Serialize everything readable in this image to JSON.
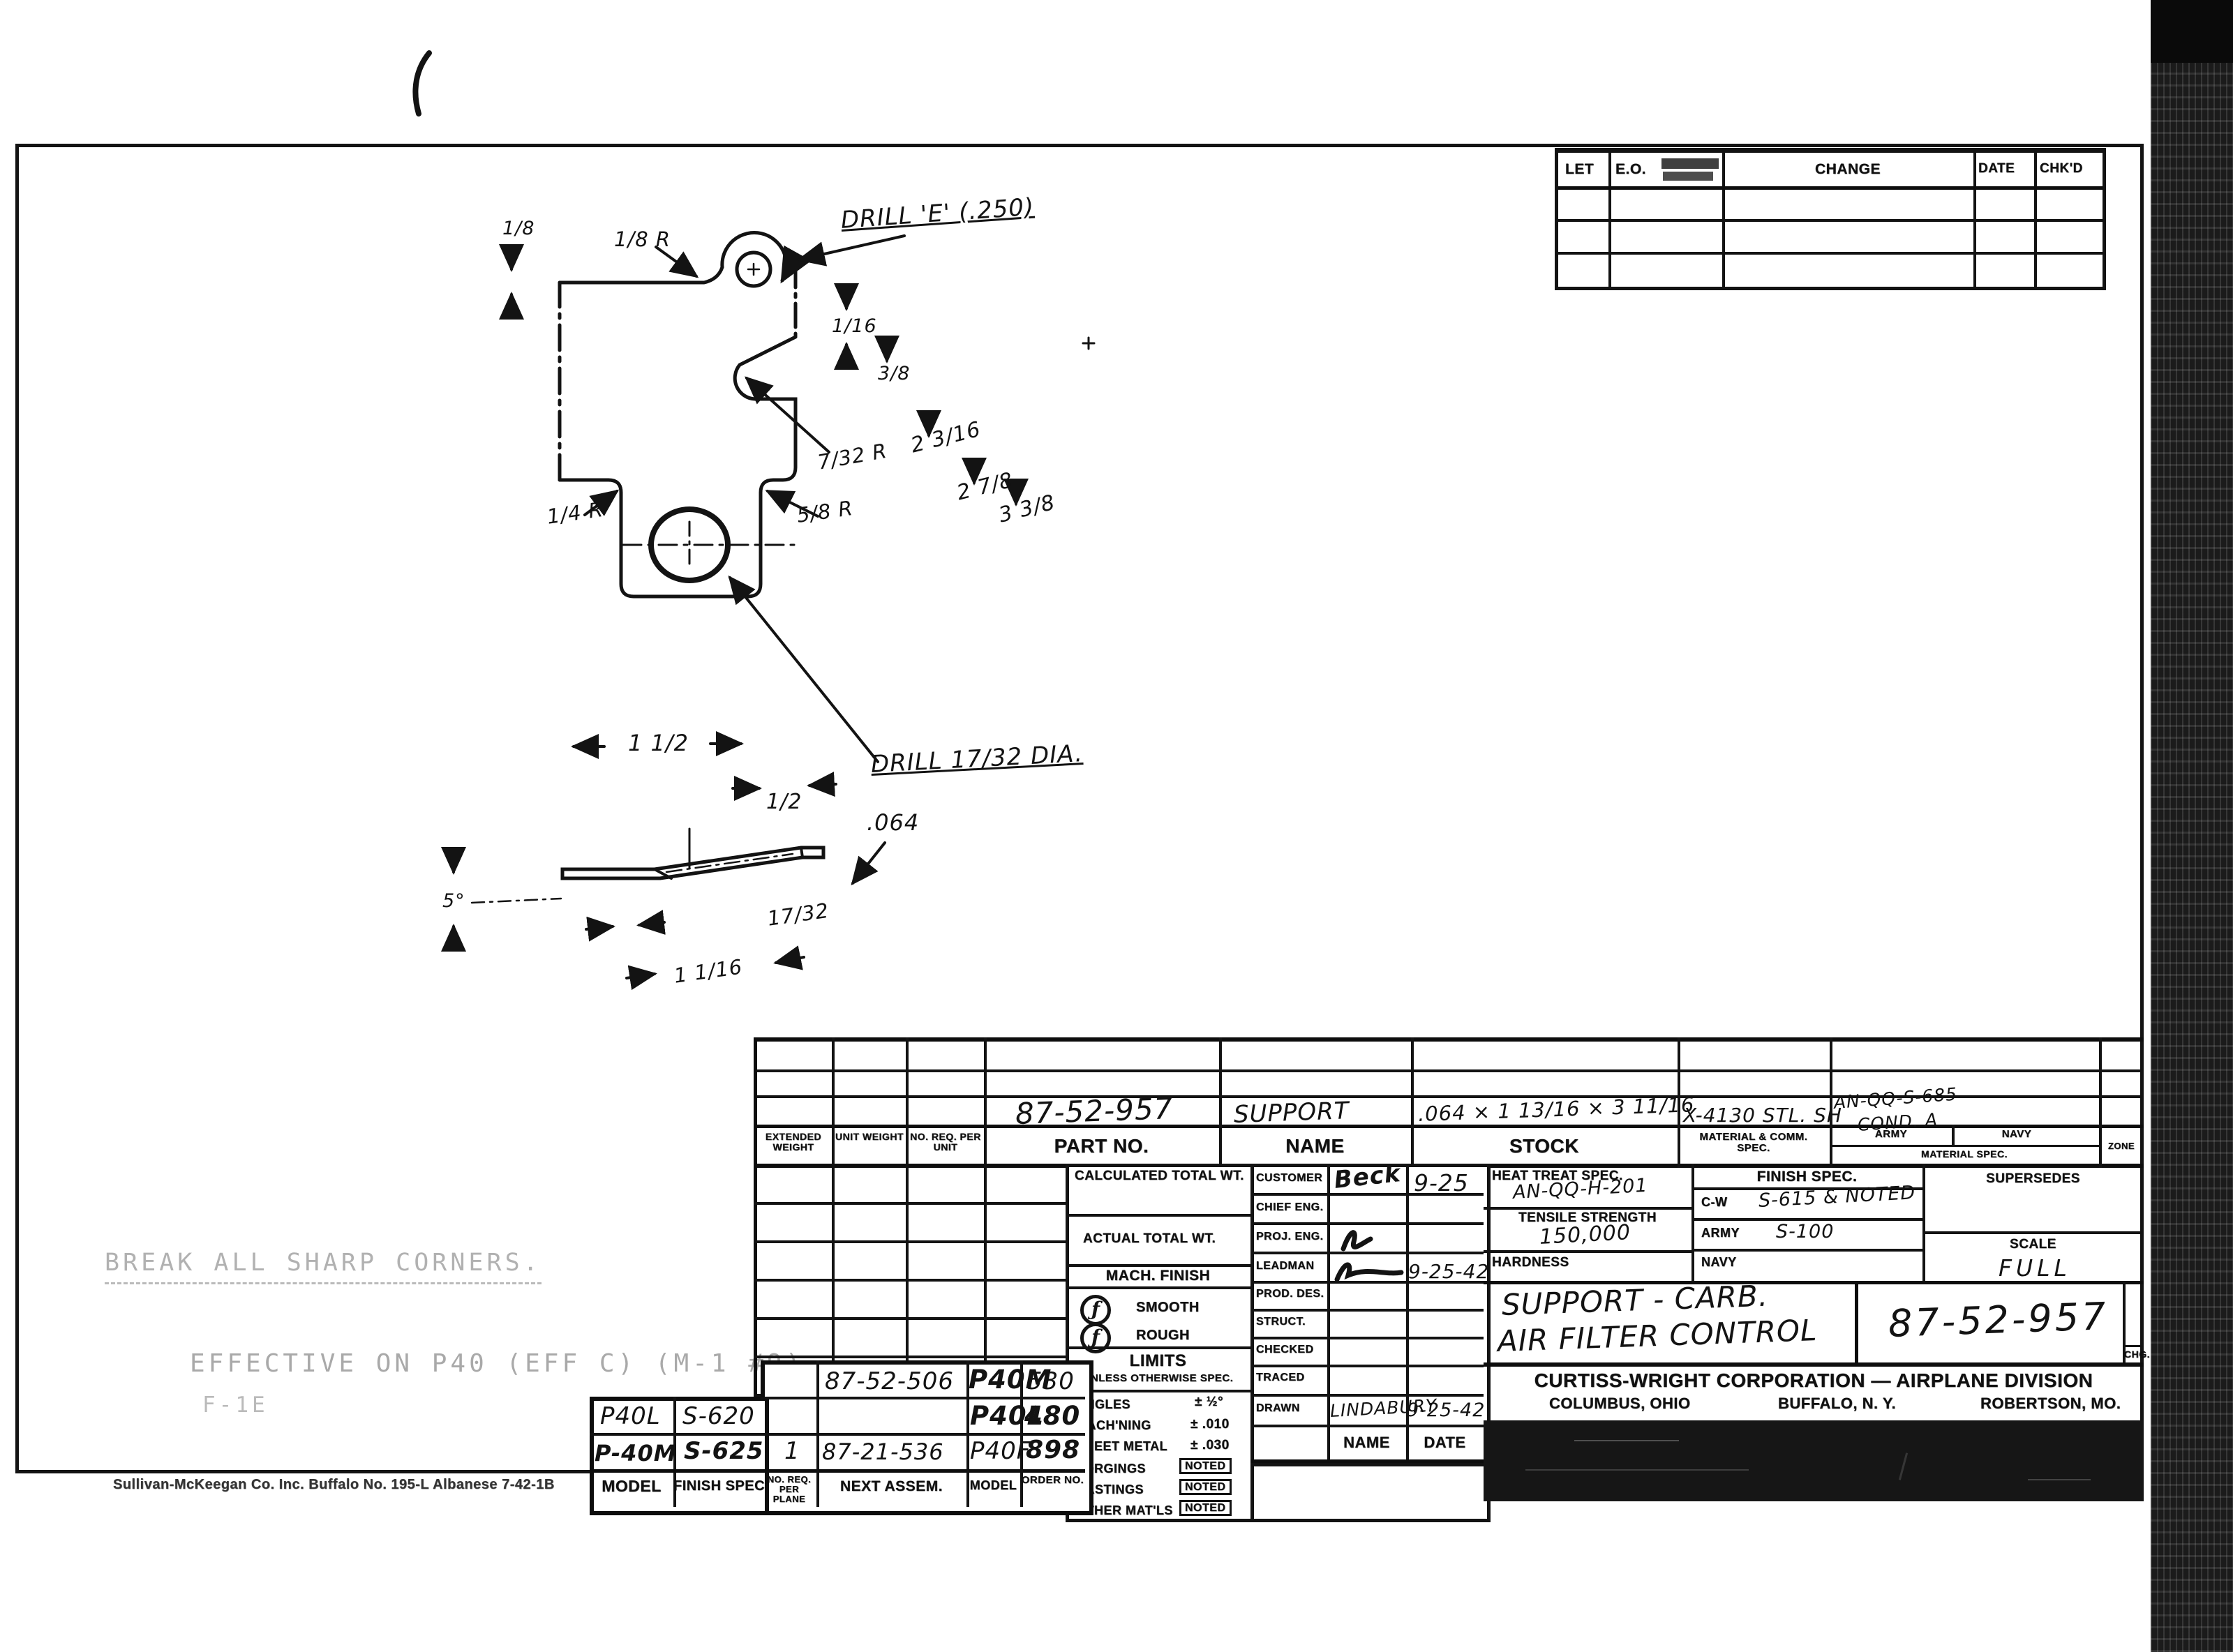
{
  "revision_table": {
    "let": "LET",
    "eo": "E.O.",
    "change": "CHANGE",
    "date": "DATE",
    "chkd": "CHK'D"
  },
  "drawing": {
    "drill_e": "DRILL 'E' (.250)",
    "drill_17_32": "DRILL 17/32 DIA.",
    "thickness": ".064",
    "dims": {
      "d_1_8": "1/8",
      "r_1_8": "1/8 R",
      "d_1_16": "1/16",
      "d_3_8": "3/8",
      "d_2_3_16": "2 3/16",
      "r_7_32": "7/32 R",
      "d_2_7_8": "2 7/8",
      "d_3_3_8": "3 3/8",
      "r_1_4": "1/4 R",
      "r_5_8": "5/8 R",
      "d_1_1_2": "1 1/2",
      "d_1_2": "1/2",
      "d_17_32": "17/32",
      "d_1_1_16": "1 1/16",
      "a_5": "5°"
    }
  },
  "stamps": {
    "break_corners": "BREAK ALL SHARP CORNERS.",
    "effective": "EFFECTIVE ON P40 (EFF C) (M-1 #9)",
    "effective_note": "F-1E"
  },
  "part_list": {
    "headers": {
      "extended_weight": "EXTENDED WEIGHT",
      "unit_weight": "UNIT WEIGHT",
      "no_req_per_unit": "NO. REQ. PER UNIT",
      "part_no": "PART NO.",
      "name": "NAME",
      "stock": "STOCK",
      "material_comm_spec": "MATERIAL & COMM. SPEC.",
      "army": "ARMY",
      "navy": "NAVY",
      "material_spec": "MATERIAL SPEC.",
      "zone": "ZONE"
    },
    "entry": {
      "part_no": "87-52-957",
      "name": "SUPPORT",
      "stock": ".064 × 1 13/16 × 3 11/16",
      "material": "X-4130 STL. SH",
      "material_spec_1": "AN-QQ-S-685",
      "material_spec_2": "COND. A"
    }
  },
  "weights": {
    "calculated": "CALCULATED TOTAL WT.",
    "actual": "ACTUAL TOTAL WT."
  },
  "mach_finish": {
    "title": "MACH. FINISH",
    "smooth": "SMOOTH",
    "rough": "ROUGH",
    "symbol": "ƒ"
  },
  "limits": {
    "title": "LIMITS",
    "subtitle": "UNLESS OTHERWISE SPEC.",
    "rows": [
      {
        "label": "ANGLES",
        "value": "± ½°"
      },
      {
        "label": "MACH'NING",
        "value": "± .010"
      },
      {
        "label": "SHEET METAL",
        "value": "± .030"
      },
      {
        "label": "FORGINGS",
        "value": "NOTED"
      },
      {
        "label": "CASTINGS",
        "value": "NOTED"
      },
      {
        "label": "OTHER MAT'LS",
        "value": "NOTED"
      }
    ]
  },
  "signatures": {
    "name_header": "NAME",
    "date_header": "DATE",
    "rows": [
      {
        "label": "CUSTOMER",
        "name": "Beck",
        "date": "9-25"
      },
      {
        "label": "CHIEF ENG.",
        "name": "",
        "date": ""
      },
      {
        "label": "PROJ. ENG.",
        "name": "",
        "date": ""
      },
      {
        "label": "LEADMAN",
        "name": "",
        "date": "9-25-42"
      },
      {
        "label": "PROD. DES.",
        "name": "",
        "date": ""
      },
      {
        "label": "STRUCT.",
        "name": "",
        "date": ""
      },
      {
        "label": "CHECKED",
        "name": "",
        "date": ""
      },
      {
        "label": "TRACED",
        "name": "",
        "date": ""
      },
      {
        "label": "DRAWN",
        "name": "LINDABURY",
        "date": "9-25-42"
      }
    ]
  },
  "specs": {
    "heat_treat_label": "HEAT TREAT SPEC.",
    "heat_treat": "AN-QQ-H-201",
    "tensile_label": "TENSILE STRENGTH",
    "tensile": "150,000",
    "hardness_label": "HARDNESS",
    "finish_label": "FINISH SPEC.",
    "cw_label": "C-W",
    "cw_value": "S-615 & NOTED",
    "army_label": "ARMY",
    "army_value": "S-100",
    "navy_label": "NAVY",
    "supersedes_label": "SUPERSEDES",
    "scale_label": "SCALE",
    "scale_value": "FULL"
  },
  "title_block": {
    "title_1": "SUPPORT - CARB.",
    "title_2": "AIR FILTER CONTROL",
    "drawing_no": "87-52-957",
    "chg": "CHG.",
    "company": "CURTISS-WRIGHT CORPORATION — AIRPLANE DIVISION",
    "loc_1": "COLUMBUS, OHIO",
    "loc_2": "BUFFALO, N. Y.",
    "loc_3": "ROBERTSON, MO."
  },
  "model_table": {
    "headers": {
      "model_left": "MODEL",
      "finish_spec": "FINISH SPEC",
      "no_req_per_plane": "NO. REQ. PER PLANE",
      "next_assem": "NEXT ASSEM.",
      "model_right": "MODEL",
      "order_no": "ORDER NO."
    },
    "rows": [
      {
        "model": "",
        "finish": "",
        "no_req": "",
        "next_assem": "87-52-506",
        "model_r": "P40M",
        "order": "530"
      },
      {
        "model": "P40L",
        "finish": "S-620",
        "no_req": "",
        "next_assem": "",
        "model_r": "P40L",
        "order": "480"
      },
      {
        "model": "P-40M",
        "finish": "S-625",
        "no_req": "1",
        "next_assem": "87-21-536",
        "model_r": "P40F",
        "order": "898"
      }
    ]
  },
  "footer": {
    "print_info": "Sullivan-McKeegan Co.  Inc.  Buffalo    No. 195-L  Albanese    7-42-1B"
  }
}
